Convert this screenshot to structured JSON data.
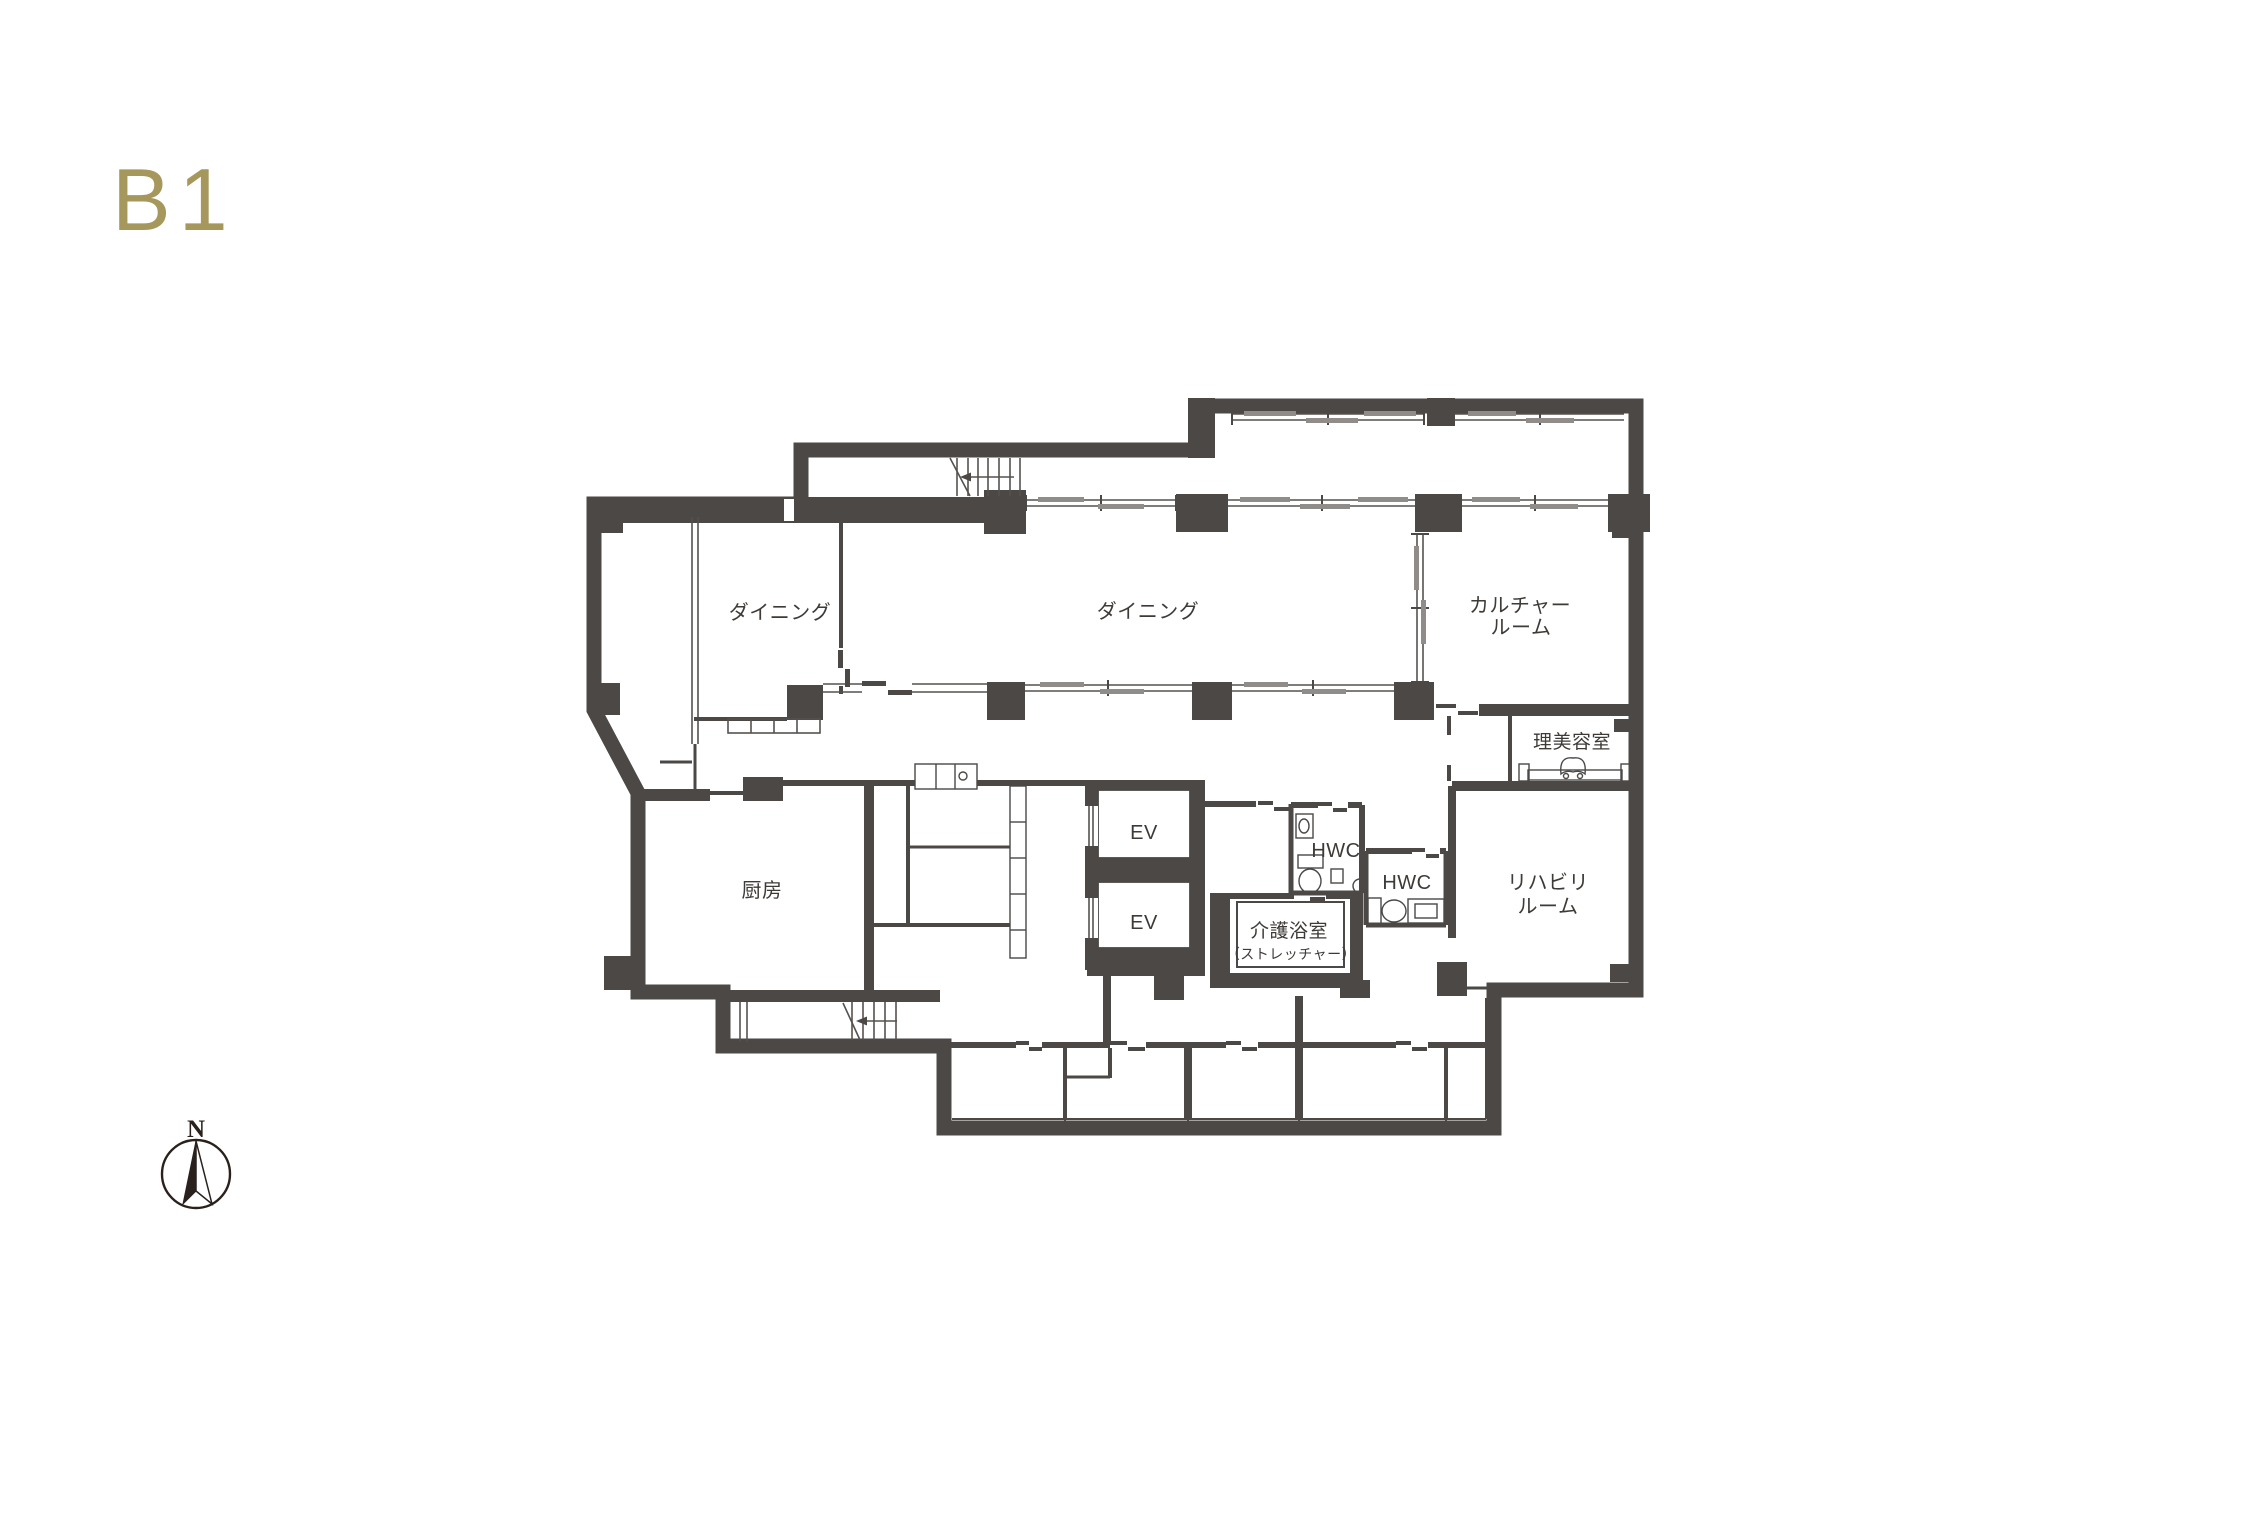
{
  "page": {
    "floor_label": "B1"
  },
  "colors": {
    "wall": "#4b4846",
    "accent_gold": "#a6985c",
    "text": "#3e3a37",
    "background": "#ffffff"
  },
  "rooms": {
    "dining_west": {
      "label": "ダイニング"
    },
    "dining_main": {
      "label": "ダイニング"
    },
    "culture_room": {
      "line1": "カルチャー",
      "line2": "ルーム"
    },
    "beauty_salon": {
      "label": "理美容室"
    },
    "kitchen": {
      "label": "厨房"
    },
    "elevator_upper": {
      "label": "EV"
    },
    "elevator_lower": {
      "label": "EV"
    },
    "accessible_wc_upper": {
      "label": "HWC"
    },
    "accessible_wc_lower": {
      "label": "HWC"
    },
    "care_bath": {
      "label": "介護浴室",
      "sublabel": "（ストレッチャー）"
    },
    "rehab_room": {
      "line1": "リハビリ",
      "line2": "ルーム"
    }
  },
  "compass": {
    "north_label": "N"
  }
}
